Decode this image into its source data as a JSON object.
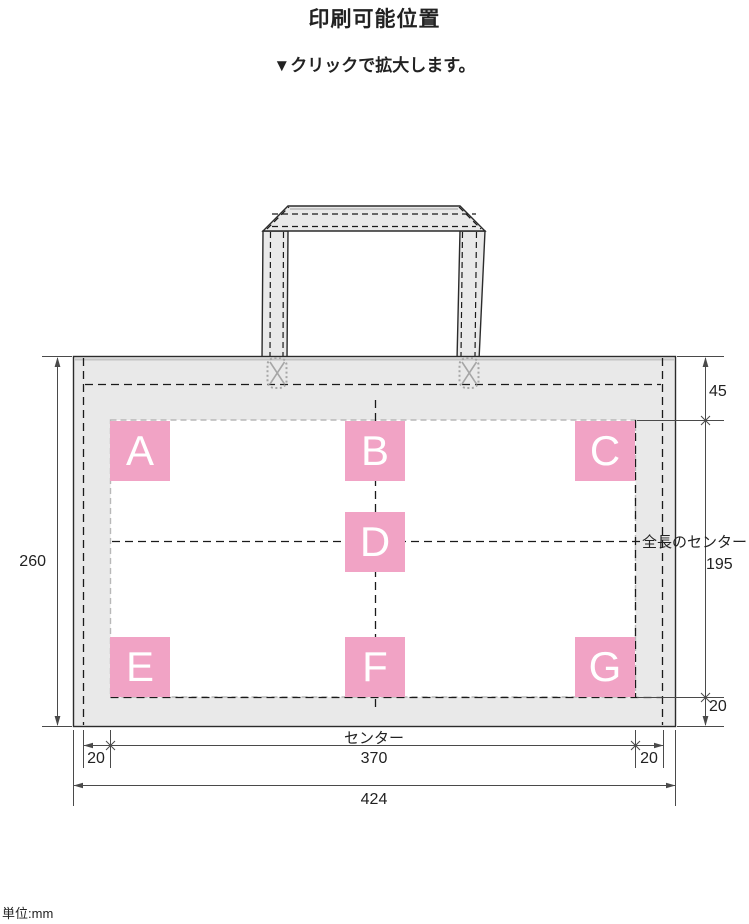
{
  "title": "印刷可能位置",
  "subtitle": "▼クリックで拡大します。",
  "unit_note": "単位:mm",
  "markers": [
    {
      "label": "A"
    },
    {
      "label": "B"
    },
    {
      "label": "C"
    },
    {
      "label": "D"
    },
    {
      "label": "E"
    },
    {
      "label": "F"
    },
    {
      "label": "G"
    }
  ],
  "dimensions": {
    "top_45": "45",
    "height_260": "260",
    "print_height_195": "195",
    "bottom_20": "20",
    "left_20": "20",
    "print_width_370": "370",
    "right_20": "20",
    "total_424": "424",
    "center_label": "センター",
    "full_length_center_label": "全長のセンター"
  },
  "colors": {
    "marker_pink": "#F1A3C5",
    "bag_gray": "#E9E9E9",
    "line_dark": "#2B2B2B",
    "dim_line_gray": "#4A4A4A",
    "stitch_gray": "#A6A6A6"
  }
}
